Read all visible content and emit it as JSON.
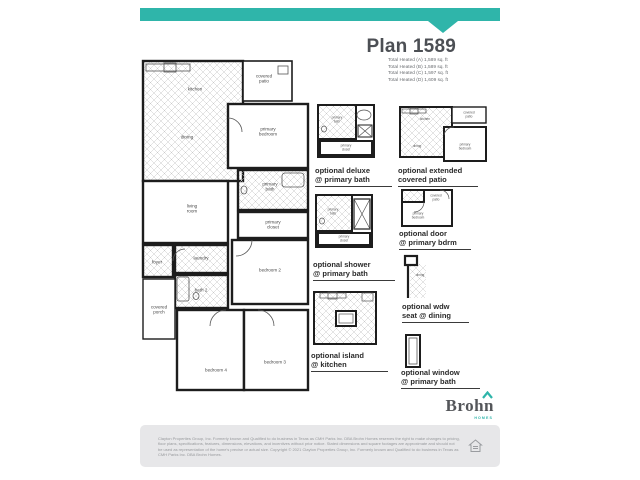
{
  "header": {
    "title": "Plan 1589",
    "specs": [
      "Total Heated (A) 1,589 sq. ft",
      "Total Heated (B) 1,589 sq. ft",
      "Total Heated (C) 1,597 sq. ft",
      "Total Heated (D) 1,609 sq. ft"
    ]
  },
  "main_plan": {
    "rooms": {
      "kitchen": "kitchen",
      "dining": "dining",
      "covered_patio": "covered patio",
      "primary_bedroom": "primary bedroom",
      "living_room": "living room",
      "primary_bath": "primary bath",
      "primary_closet": "primary closet",
      "bedroom2": "bedroom 2",
      "foyer": "foyer",
      "laundry": "laundry",
      "bath2": "bath 2",
      "covered_porch": "covered porch",
      "bedroom4": "bedroom 4",
      "bedroom3": "bedroom 3"
    }
  },
  "options": {
    "deluxe": {
      "line1": "optional deluxe",
      "line2": "@ primary bath",
      "rooms": {
        "bath": "primary bath",
        "closet": "primary closet"
      }
    },
    "extended_patio": {
      "line1": "optional extended",
      "line2": "covered patio",
      "rooms": {
        "kitchen": "kitchen",
        "dining": "dining",
        "patio": "covered patio",
        "bedroom": "primary bedroom"
      }
    },
    "shower": {
      "line1": "optional shower",
      "line2": "@ primary bath",
      "rooms": {
        "bath": "primary bath",
        "closet": "primary closet"
      }
    },
    "door": {
      "line1": "optional door",
      "line2": "@ primary bdrm",
      "rooms": {
        "patio": "covered patio",
        "bedroom": "primary bedroom"
      }
    },
    "wdw_seat": {
      "line1": "optional wdw",
      "line2": "seat @ dining",
      "rooms": {
        "dining": "dining"
      }
    },
    "island": {
      "line1": "optional island",
      "line2": "@ kitchen"
    },
    "window": {
      "line1": "optional window",
      "line2": "@ primary bath"
    }
  },
  "logo": {
    "name": "Brohn",
    "sub": "HOMES"
  },
  "footer": {
    "disclaimer": "Clayton Properties Group, Inc. Formerly known and Qualified to do business in Texas as CMH Parks Inc. DBA Brohn Homes reserves the right to make changes to pricing, floor plans, specifications, features, dimensions, elevations, and incentives without prior notice. Stated dimensions and square footages are approximate and should not be used as representation of the home's precise or actual size. Copyright © 2021 Clayton Properties Group, Inc. Formerly known and Qualified to do business in Texas as CMH Parks Inc. DBA Brohn Homes."
  },
  "colors": {
    "teal": "#2fb5aa",
    "title_gray": "#4c4f54",
    "plan_line": "#231f20",
    "footer_bg": "#e7e7e9",
    "footer_text": "#97999c"
  }
}
